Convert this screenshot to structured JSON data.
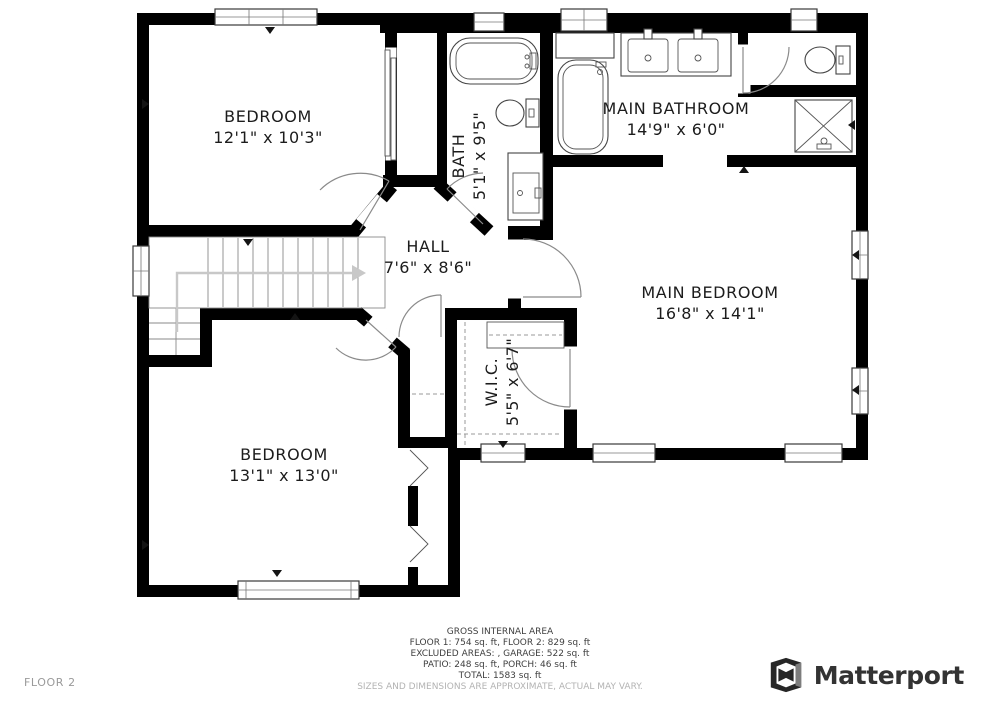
{
  "floorplan": {
    "rooms": [
      {
        "id": "bedroom-1",
        "name": "BEDROOM",
        "dims": "12'1\" x 10'3\""
      },
      {
        "id": "bath",
        "name": "BATH",
        "dims": "5'1\" x 9'5\""
      },
      {
        "id": "main-bathroom",
        "name": "MAIN BATHROOM",
        "dims": "14'9\" x 6'0\""
      },
      {
        "id": "hall",
        "name": "HALL",
        "dims": "7'6\" x 8'6\""
      },
      {
        "id": "main-bedroom",
        "name": "MAIN BEDROOM",
        "dims": "16'8\" x 14'1\""
      },
      {
        "id": "wic",
        "name": "W.I.C.",
        "dims": "5'5\" x 6'7\""
      },
      {
        "id": "bedroom-2",
        "name": "BEDROOM",
        "dims": "13'1\" x 13'0\""
      }
    ],
    "fixtures": [
      "bathtub",
      "toilet",
      "sink-vanity",
      "double-vanity",
      "shower",
      "staircase",
      "bifold-closet-doors",
      "sliding-closet-doors",
      "closet-rod",
      "windows",
      "door-swings"
    ],
    "colors": {
      "wall": "#000000",
      "floor": "#ffffff",
      "door_arc": "#8a8a8a",
      "stairs_arrow": "#c8c8c8",
      "window_fill": "#ffffff"
    }
  },
  "footer": {
    "title": "GROSS INTERNAL AREA",
    "line1": "FLOOR 1: 754 sq. ft, FLOOR 2: 829 sq. ft",
    "line2": "EXCLUDED AREAS: , GARAGE: 522 sq. ft",
    "line3": "PATIO: 248 sq. ft, PORCH: 46 sq. ft",
    "line4": "TOTAL: 1583 sq. ft",
    "disclaimer": "SIZES AND DIMENSIONS ARE APPROXIMATE, ACTUAL MAY VARY."
  },
  "page": {
    "floor_label": "FLOOR 2",
    "brand": "Matterport"
  }
}
